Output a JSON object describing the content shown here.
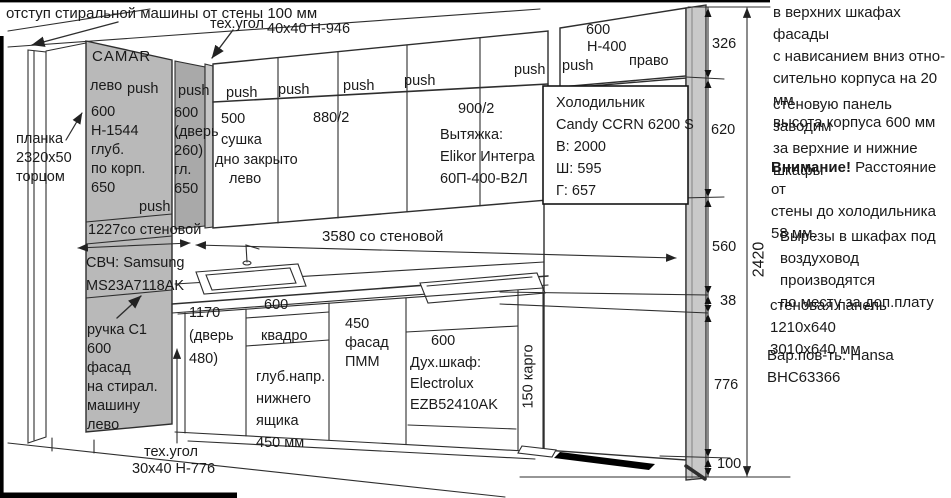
{
  "colors": {
    "cabinet_panel_gray": "#b9b9b9",
    "narrow_panel_gray": "#a9a9a9",
    "drawing_line": "#2e2e2e"
  },
  "notes": {
    "washer_offset": "отступ стиральной машины от стены 100 мм",
    "top_right_1": "в верхних шкафах фасады\nс нависанием вниз отно-\nсительно корпуса на 20 мм\nвысота корпуса 600 мм",
    "wall_panel_behind": "стеновую панель заводим\nза верхние и нижние\nшкафы",
    "attention_bold": "Внимание!",
    "attention_rest": " Расстояние от\nстены до холодильника\n58 мм.",
    "cutouts": "Вырезы в шкафах под\nвоздуховод производятся\nпо месту за доп.плату",
    "wall_panel_sizes": "стеновая панель 1210x640\n3010x640 мм",
    "worktop_variant": "Вар.пов-ть: Hansa BHC63366"
  },
  "tech_corners": {
    "top_label": "тех.угол",
    "top_size": "40x40 Н-946",
    "bottom_label": "тех.угол",
    "bottom_size": "30x40 Н-776"
  },
  "left_column": {
    "plank": "планка\n2320x50\nторцом",
    "camar_brand": "CAMAR",
    "camar_hinge": "лево",
    "camar_push": "push",
    "camar_specs": "600\nН-1544\nглуб.\nпо корп.\n650",
    "camar_push2": "push",
    "microwave": "СВЧ: Samsung\nMS23A7118AK",
    "washer_facade": "ручка С1\n600\nфасад\nна стирал.\nмашину\nлево"
  },
  "column2": {
    "push": "push",
    "specs": "600\n(дверь\n260)\nгл.\n650"
  },
  "upper_cabinets": {
    "pushes": [
      "push",
      "push",
      "push",
      "push",
      "push"
    ],
    "cab500": "500\nсушка",
    "cab500_bottom": "дно закрыто",
    "cab500_hinge": "лево",
    "cab880": "880/2",
    "cab900": "900/2",
    "hood": "Вытяжка:\nElikor Интегра\n60П-400-В2Л",
    "fridge_top_width": "600",
    "fridge_top_height": "Н-400",
    "fridge_top_push": "push",
    "fridge_top_hinge": "право"
  },
  "fridge": {
    "info": "Холодильник\nCandy CCRN 6200 S\nВ: 2000\nШ: 595\nГ: 657"
  },
  "base_cabinets": {
    "cab1170": "1170\n(дверь\n480)",
    "cab600kv_width": "600",
    "cab600kv_name": "квадро",
    "drawer_depth": "глуб.напр.\nнижнего\nящика\n450 мм",
    "pmm": "450\nфасад\nПММ",
    "oven_width": "600",
    "oven": "Дух.шкаф:\nElectrolux\nEZB52410AK",
    "cargo": "150 карго"
  },
  "dimensions": {
    "d326": "326",
    "d620": "620",
    "d560": "560",
    "d38": "38",
    "d776": "776",
    "d100": "100",
    "d2420": "2420",
    "d1227": "1227со стеновой",
    "d3580": "3580 со стеновой"
  }
}
